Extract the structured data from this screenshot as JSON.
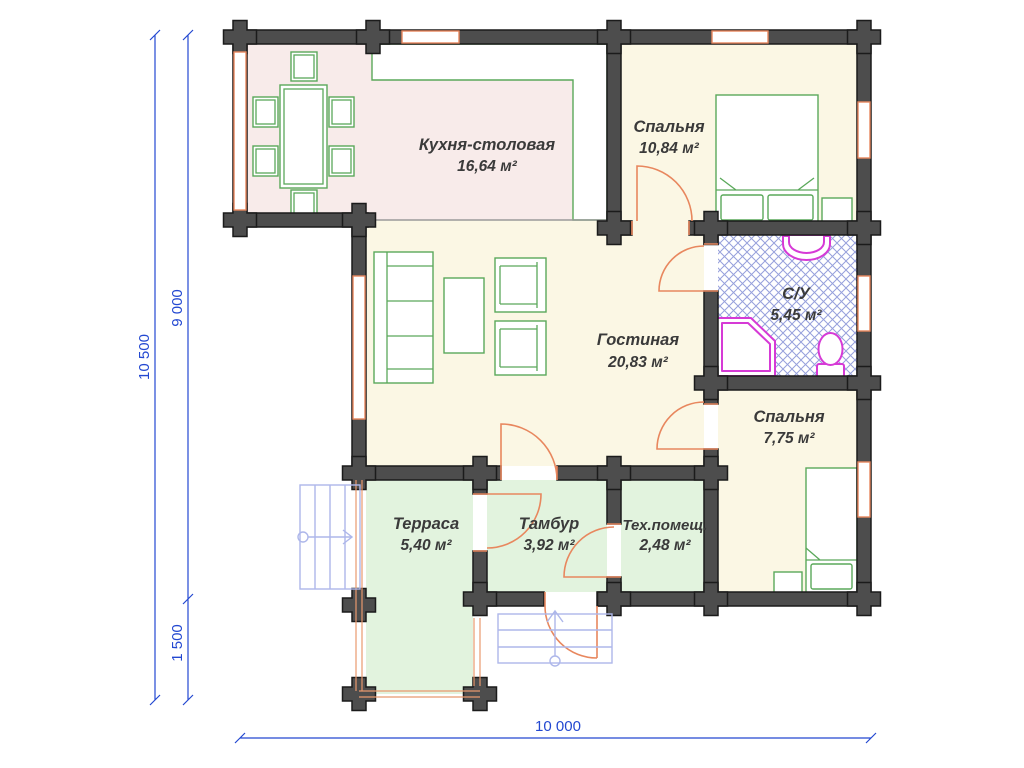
{
  "title": "План дома",
  "rooms": [
    {
      "id": "kitchen-dining",
      "name": "Кухня-столовая",
      "area": "16,64 м²"
    },
    {
      "id": "bedroom-1",
      "name": "Спальня",
      "area": "10,84 м²"
    },
    {
      "id": "living-room",
      "name": "Гостиная",
      "area": "20,83 м²"
    },
    {
      "id": "bathroom",
      "name": "С/У",
      "area": "5,45 м²"
    },
    {
      "id": "bedroom-2",
      "name": "Спальня",
      "area": "7,75 м²"
    },
    {
      "id": "terrace",
      "name": "Терраса",
      "area": "5,40 м²"
    },
    {
      "id": "vestibule",
      "name": "Тамбур",
      "area": "3,92 м²"
    },
    {
      "id": "tech-room",
      "name": "Тех.помещ.",
      "area": "2,48 м²"
    }
  ],
  "dimensions": {
    "left_total": "10 500",
    "left_upper": "9 000",
    "left_lower": "1 500",
    "bottom_total": "10 000"
  },
  "colors": {
    "wall": "#4d4d4d",
    "kitchen_floor": "#f8ebea",
    "bedroom_floor": "#fbf7e4",
    "green_floor": "#e2f3de",
    "bath_hatch": "#96a0dc",
    "furniture": "#5aa85a",
    "doors_windows": "#e8875e",
    "sanitary": "#d63ad6",
    "dimension": "#2348d1",
    "stairs": "#aeb7ea"
  }
}
